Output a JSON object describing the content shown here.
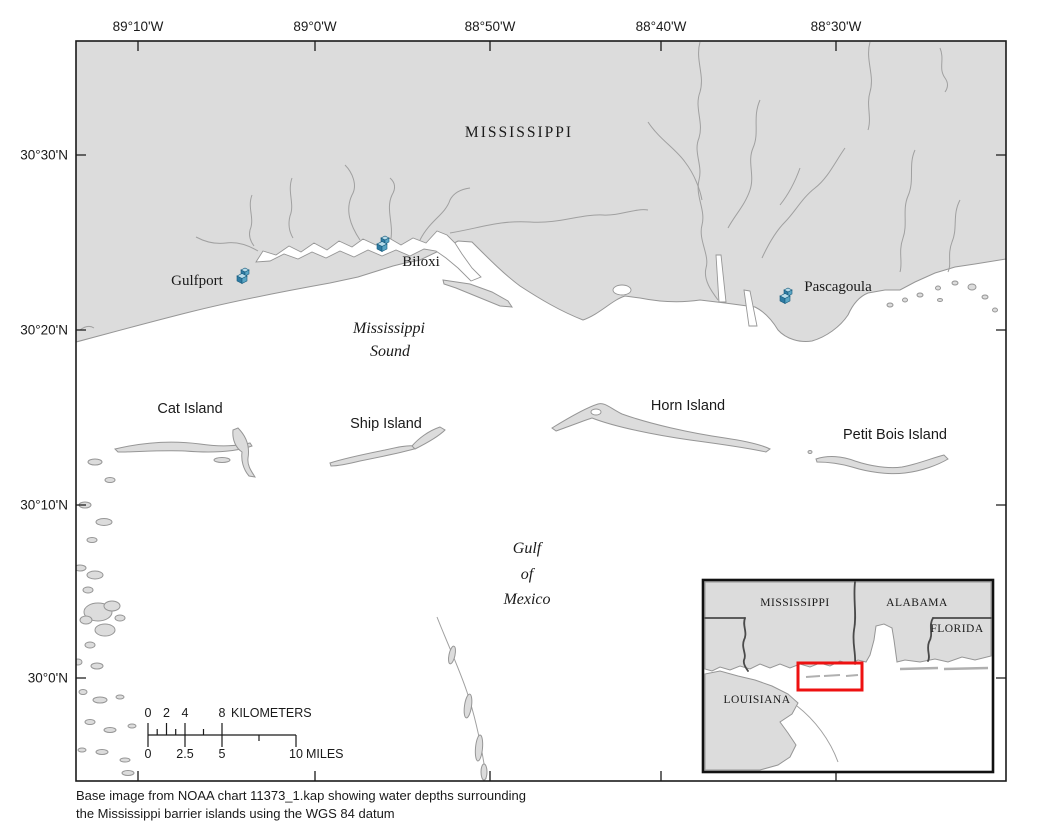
{
  "figure": {
    "region_label": "MISSISSIPPI",
    "water_labels": {
      "sound_line1": "Mississippi",
      "sound_line2": "Sound",
      "gulf_line1": "Gulf",
      "gulf_line2": "of",
      "gulf_line3": "Mexico"
    },
    "cities": [
      {
        "name": "Gulfport"
      },
      {
        "name": "Biloxi"
      },
      {
        "name": "Pascagoula"
      }
    ],
    "islands": [
      {
        "name": "Cat Island"
      },
      {
        "name": "Ship Island"
      },
      {
        "name": "Horn Island"
      },
      {
        "name": "Petit Bois Island"
      }
    ],
    "city_marker_icon": "blue-3d-buildings"
  },
  "axes": {
    "top": [
      {
        "label": "89°10'W"
      },
      {
        "label": "89°0'W"
      },
      {
        "label": "88°50'W"
      },
      {
        "label": "88°40'W"
      },
      {
        "label": "88°30'W"
      }
    ],
    "left": [
      {
        "label": "30°30'N"
      },
      {
        "label": "30°20'N"
      },
      {
        "label": "30°10'N"
      },
      {
        "label": "30°0'N"
      }
    ]
  },
  "scale_bar": {
    "km_labels": [
      "0",
      "2",
      "4",
      "8"
    ],
    "km_unit": "KILOMETERS",
    "mile_labels": [
      "0",
      "2.5",
      "5",
      "10"
    ],
    "mile_unit": "MILES"
  },
  "inset": {
    "states": [
      {
        "name": "MISSISSIPPI"
      },
      {
        "name": "ALABAMA"
      },
      {
        "name": "FLORIDA"
      },
      {
        "name": "LOUISIANA"
      }
    ],
    "highlight_color": "#ee1111"
  },
  "caption": {
    "line1": "Base image from NOAA chart 11373_1.kap showing water depths surrounding",
    "line2": "the Mississippi barrier islands using the WGS 84 datum"
  },
  "colors": {
    "land": "#dcdcdc",
    "shoreline": "#969696",
    "frame": "#1a1a1a",
    "city_marker": "#2e7ba3",
    "highlight_red": "#ee1111"
  }
}
